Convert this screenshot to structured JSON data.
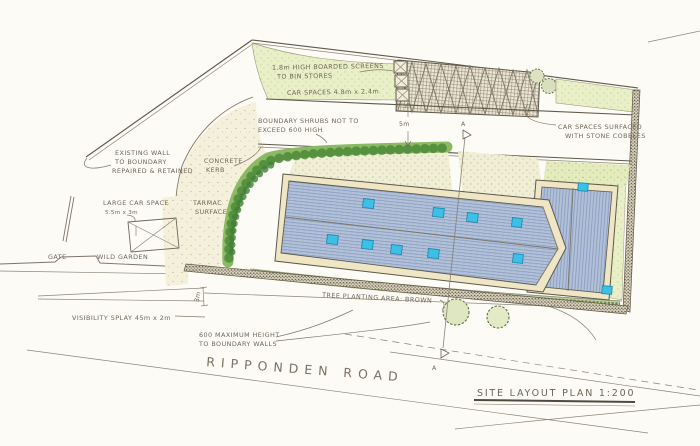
{
  "drawing": {
    "title_block": {
      "title": "SITE LAYOUT PLAN 1:200"
    },
    "road_name": "RIPPONDEN ROAD",
    "annotations": {
      "bin_screens": [
        "1.8m HIGH BOARDED SCREENS",
        "TO BIN STORES"
      ],
      "car_spaces_top": "CAR SPACES 4.8m x 2.4m",
      "car_spaces_cobbles": [
        "CAR SPACES SURFACED",
        "WITH STONE COBBLES"
      ],
      "boundary_shrubs": [
        "BOUNDARY SHRUBS NOT TO",
        "EXCEED 600 HIGH"
      ],
      "existing_wall": [
        "EXISTING WALL",
        "TO BOUNDARY",
        "REPAIRED & RETAINED"
      ],
      "concrete_kerb": [
        "CONCRETE",
        "KERB"
      ],
      "large_car_space": [
        "LARGE CAR SPACE",
        "5.5m x 3m"
      ],
      "tarmac": [
        "TARMAC",
        "SURFACE"
      ],
      "gate": "GATE",
      "wild_garden": "WILD GARDEN",
      "visibility_splay": "VISIBILITY SPLAY 45m x 2m",
      "max_height": [
        "600 MAXIMUM HEIGHT",
        "TO BOUNDARY WALLS"
      ],
      "tree_planting": "TREE PLANTING AREA: BROWN"
    },
    "dimensions": {
      "five_m": "5m",
      "three_m": "3m"
    },
    "section_marker": "A",
    "colors": {
      "paper": "#fcfbf5",
      "ink": "#6f675a",
      "roof_blue": "#b5c3da",
      "roof_hatch": "#8197bc",
      "skylight_cyan": "#3cc0e6",
      "shrub_green": "#6fae4e",
      "shrub_dark": "#3f7f33",
      "lawn_pale": "#f0efd4",
      "lawn_green": "#e4ecbe",
      "tarmac_cream": "#f5f0dc",
      "wall_band": "#efe6c6",
      "cobble_grey": "#8a8272"
    }
  }
}
